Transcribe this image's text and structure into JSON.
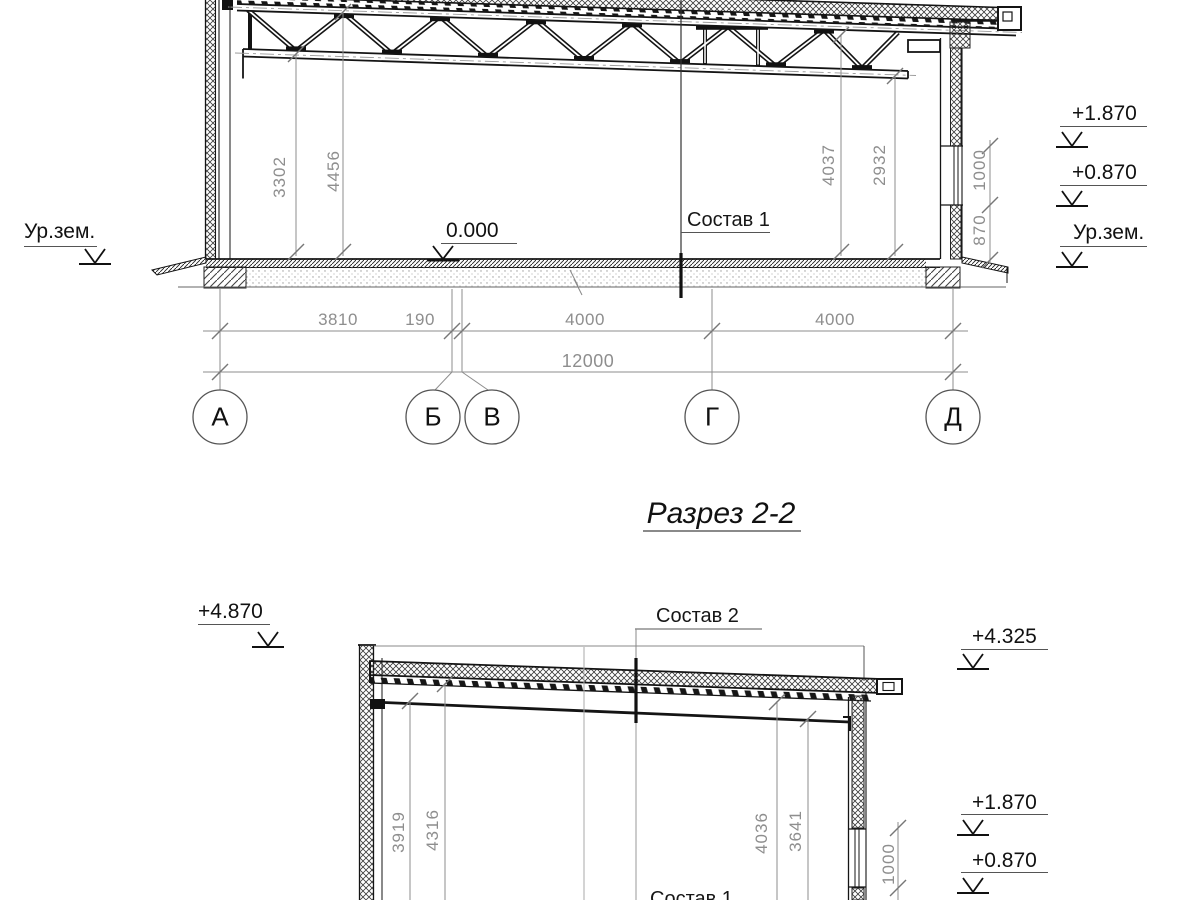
{
  "section_title": "Разрез 2-2",
  "upper": {
    "ground_left": "Ур.зем.",
    "level_zero": "0.000",
    "floor_callout": "Состав 1",
    "level_1870": "+1.870",
    "level_0870": "+0.870",
    "ground_right": "Ур.зем.",
    "dim_left_inner": "3302",
    "dim_left_outer": "4456",
    "dim_right_outer": "4037",
    "dim_right_inner": "2932",
    "dim_window_head": "1000",
    "dim_window_sill": "870",
    "span_dims": [
      "3810",
      "190",
      "4000",
      "4000"
    ],
    "total_span": "12000",
    "axis_labels": [
      "А",
      "Б",
      "В",
      "Г",
      "Д"
    ]
  },
  "lower": {
    "level_4870": "+4.870",
    "roof_callout": "Состав 2",
    "level_4325": "+4.325",
    "level_1870": "+1.870",
    "level_0870": "+0.870",
    "floor_callout": "Состав 1",
    "dim_left_beam": "3919",
    "dim_left_deck": "4316",
    "dim_right_deck": "4036",
    "dim_right_beam": "3641",
    "dim_window_head": "1000"
  }
}
